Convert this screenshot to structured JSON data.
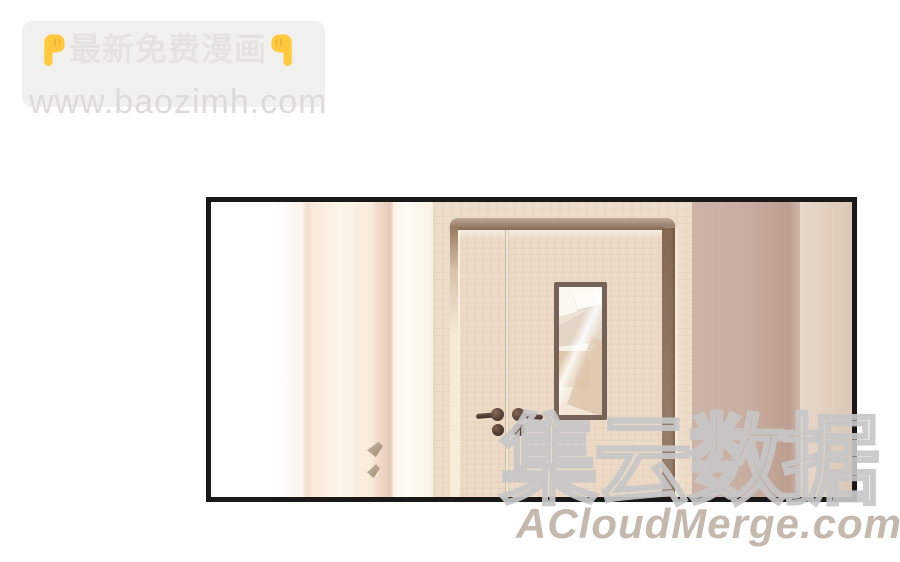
{
  "watermark_top": {
    "title": "最新免费漫画",
    "url": "www.baozimh.com",
    "left_icon": "point-down-hand",
    "right_icon": "point-down-hand",
    "colors": {
      "box": "#f0f0ef",
      "title_text": "#e5e3e0",
      "url_text": "#dcdbd9",
      "hand": "#FFC83D"
    }
  },
  "panel": {
    "colors": {
      "border": "#191919",
      "left_wall": "#ffffff",
      "pink_edge": "#f3dccd",
      "cream_stripe": "#fbf3e2",
      "pink_stripe": "#efd6c6",
      "ivory_stripe": "#fdf9ee",
      "casing_wood": "#eddcca",
      "molding": "#9a7d63",
      "door_wood": "#ecdac6",
      "window_frame": "#756357",
      "mauve_wall": "#c9ada0",
      "beige_stripe": "#e2cfbe"
    }
  },
  "watermark_bottom": {
    "brand": "集云数据",
    "site": "ACloudMerge.com",
    "colors": {
      "brand_outline": "#c7c7c7",
      "site_text": "#c4b9ac"
    }
  }
}
